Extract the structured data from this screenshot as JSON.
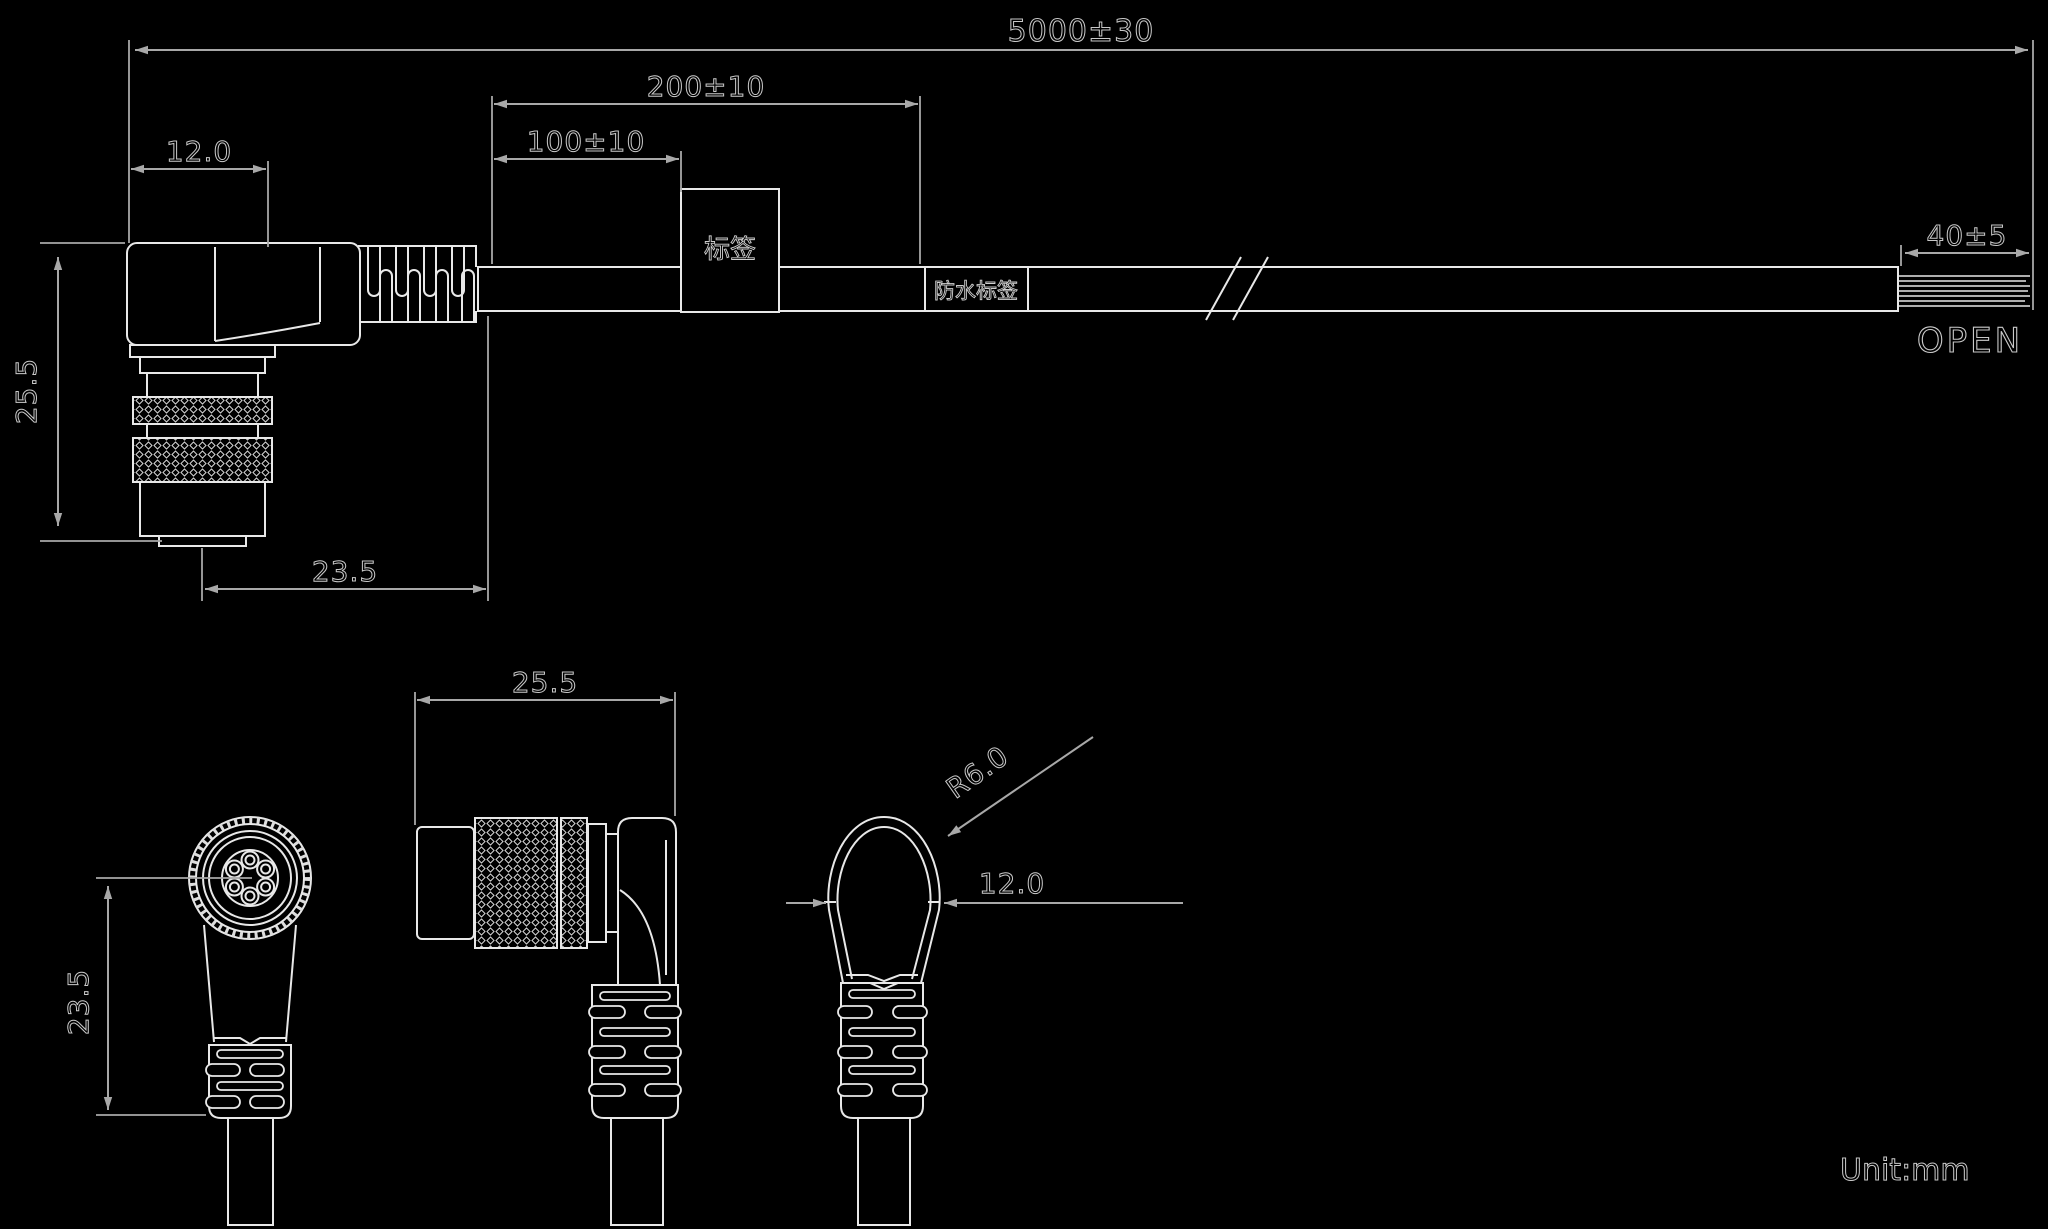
{
  "dims": {
    "overall": "5000±30",
    "seg200": "200±10",
    "seg100": "100±10",
    "width12": "12.0",
    "height25_5": "25.5",
    "body23_5": "23.5",
    "strip40": "40±5",
    "open": "OPEN",
    "front_height": "23.5",
    "side_length": "25.5",
    "rear_radius": "R6.0",
    "rear_width": "12.0"
  },
  "labels": {
    "tag": "标签",
    "waterproof_tag": "防水标签"
  },
  "note": {
    "unit": "Unit:mm"
  },
  "colors": {
    "background": "#000000",
    "outline": "#e8e8e8",
    "dimension": "#a8a8a8"
  }
}
